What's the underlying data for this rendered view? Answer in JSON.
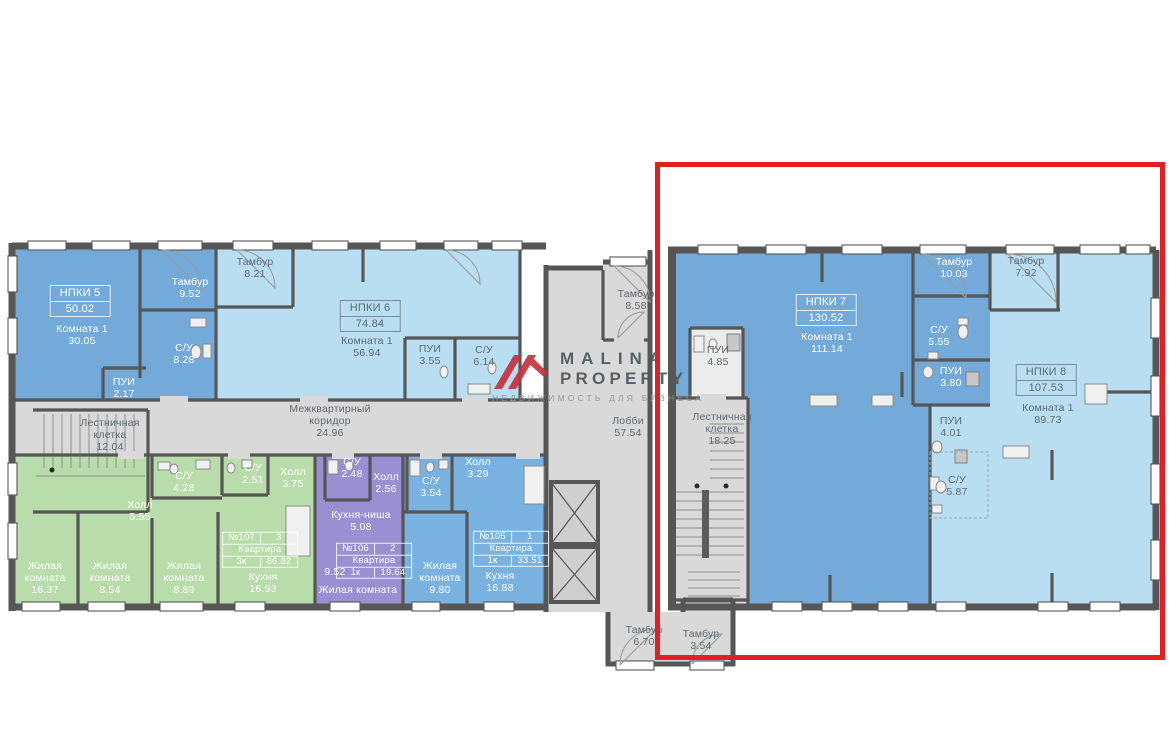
{
  "watermark": {
    "brand_line1": "MALINA",
    "brand_line2": "PROPERTY",
    "tagline": "НЕДВИЖИМОСТЬ ДЛЯ БИЗНЕСА",
    "logo_color": "#c8323c"
  },
  "highlight": {
    "color": "#e31e24"
  },
  "colors": {
    "wall": "#565656",
    "floor_gray": "#d9d9d9",
    "blue_med": "#73aad9",
    "blue_light": "#b9def2",
    "blue_apt": "#79b2e0",
    "green": "#b8dcaa",
    "purple": "#9a8fd2",
    "red": "#e31e24"
  },
  "labels": [
    {
      "id": "npki5-title",
      "type": "titlebox",
      "tone": "light",
      "x": 80,
      "y": 301,
      "lines": [
        "НПКИ 5",
        "50.02"
      ]
    },
    {
      "id": "npki5-room",
      "type": "stack",
      "tone": "light",
      "x": 82,
      "y": 336,
      "lines": [
        "Комната 1",
        "30.05"
      ]
    },
    {
      "id": "npki5-tambur",
      "type": "stack",
      "tone": "light",
      "x": 190,
      "y": 289,
      "lines": [
        "Тамбур",
        "9.52"
      ]
    },
    {
      "id": "npki5-su",
      "type": "stack",
      "tone": "light",
      "x": 184,
      "y": 355,
      "lines": [
        "С/У",
        "8.28"
      ]
    },
    {
      "id": "npki5-pui",
      "type": "stack",
      "tone": "light",
      "x": 124,
      "y": 389,
      "lines": [
        "ПУИ",
        "2.17"
      ]
    },
    {
      "id": "stairwell-12",
      "type": "stack",
      "tone": "dark",
      "x": 110,
      "y": 436,
      "lines": [
        "Лестничная",
        "клетка",
        "12.04"
      ]
    },
    {
      "id": "tambur-821",
      "type": "stack",
      "tone": "dark",
      "x": 255,
      "y": 269,
      "lines": [
        "Тамбур",
        "8.21"
      ]
    },
    {
      "id": "npki6-title",
      "type": "titlebox",
      "tone": "dark",
      "x": 370,
      "y": 316,
      "lines": [
        "НПКИ 6",
        "74.84"
      ]
    },
    {
      "id": "npki6-room",
      "type": "stack",
      "tone": "dark",
      "x": 367,
      "y": 348,
      "lines": [
        "Комната 1",
        "56.94"
      ]
    },
    {
      "id": "npki6-pui",
      "type": "stack",
      "tone": "dark",
      "x": 430,
      "y": 356,
      "lines": [
        "ПУИ",
        "3.55"
      ]
    },
    {
      "id": "npki6-su",
      "type": "stack",
      "tone": "dark",
      "x": 484,
      "y": 357,
      "lines": [
        "С/У",
        "6.14"
      ]
    },
    {
      "id": "corridor",
      "type": "stack",
      "tone": "dark",
      "x": 330,
      "y": 422,
      "lines": [
        "Межквартирный",
        "коридор",
        "24.96"
      ]
    },
    {
      "id": "a107-hall1",
      "type": "stack",
      "tone": "light",
      "x": 140,
      "y": 512,
      "lines": [
        "Холл",
        "5.55"
      ]
    },
    {
      "id": "a107-su1",
      "type": "stack",
      "tone": "light",
      "x": 184,
      "y": 483,
      "lines": [
        "С/У",
        "4.28"
      ]
    },
    {
      "id": "a107-su2",
      "type": "stack",
      "tone": "light",
      "x": 253,
      "y": 475,
      "lines": [
        "С/У",
        "2.51"
      ]
    },
    {
      "id": "a107-hall2",
      "type": "stack",
      "tone": "light",
      "x": 293,
      "y": 479,
      "lines": [
        "Холл",
        "3.75"
      ]
    },
    {
      "id": "a107-room1",
      "type": "stack",
      "tone": "light",
      "x": 45,
      "y": 579,
      "lines": [
        "Жилая",
        "комната",
        "16.37"
      ]
    },
    {
      "id": "a107-room2",
      "type": "stack",
      "tone": "light",
      "x": 110,
      "y": 579,
      "lines": [
        "Жилая",
        "комната",
        "8.54"
      ]
    },
    {
      "id": "a107-room3",
      "type": "stack",
      "tone": "light",
      "x": 184,
      "y": 579,
      "lines": [
        "Жилая",
        "комната",
        "8.89"
      ]
    },
    {
      "id": "a107-kitchen",
      "type": "stack",
      "tone": "light",
      "x": 263,
      "y": 584,
      "lines": [
        "Кухня",
        "16.93"
      ]
    },
    {
      "id": "a107-box",
      "type": "aptbox",
      "tone": "light",
      "x": 260,
      "y": 550,
      "rows": [
        [
          "№107",
          "3"
        ],
        [
          "Квартира"
        ],
        [
          "3к",
          "66.82"
        ]
      ]
    },
    {
      "id": "a106-su",
      "type": "stack",
      "tone": "light",
      "x": 352,
      "y": 469,
      "lines": [
        "С/У",
        "2.48"
      ]
    },
    {
      "id": "a106-hall",
      "type": "stack",
      "tone": "light",
      "x": 386,
      "y": 484,
      "lines": [
        "Холл",
        "2.56"
      ]
    },
    {
      "id": "a106-niche",
      "type": "stack",
      "tone": "light",
      "x": 361,
      "y": 522,
      "lines": [
        "Кухня-ниша",
        "5.08"
      ]
    },
    {
      "id": "a106-box",
      "type": "aptbox",
      "tone": "light",
      "x": 374,
      "y": 561,
      "rows": [
        [
          "№106",
          "2"
        ],
        [
          "Квартира"
        ],
        [
          "1к",
          "19.64"
        ]
      ]
    },
    {
      "id": "a106-area",
      "type": "stack",
      "tone": "light",
      "x": 335,
      "y": 573,
      "lines": [
        "9.52"
      ]
    },
    {
      "id": "a106-room",
      "type": "stack",
      "tone": "light",
      "x": 358,
      "y": 591,
      "lines": [
        "Жилая комната"
      ]
    },
    {
      "id": "a105-su",
      "type": "stack",
      "tone": "light",
      "x": 431,
      "y": 488,
      "lines": [
        "С/У",
        "3.54"
      ]
    },
    {
      "id": "a105-hall",
      "type": "stack",
      "tone": "light",
      "x": 478,
      "y": 469,
      "lines": [
        "Холл",
        "3.29"
      ]
    },
    {
      "id": "a105-room",
      "type": "stack",
      "tone": "light",
      "x": 440,
      "y": 579,
      "lines": [
        "Жилая",
        "комната",
        "9.80"
      ]
    },
    {
      "id": "a105-box",
      "type": "aptbox",
      "tone": "light",
      "x": 511,
      "y": 549,
      "rows": [
        [
          "№105",
          "1"
        ],
        [
          "Квартира"
        ],
        [
          "1к",
          "33.51"
        ]
      ]
    },
    {
      "id": "a105-kitchen",
      "type": "stack",
      "tone": "light",
      "x": 500,
      "y": 583,
      "lines": [
        "Кухня",
        "16.88"
      ]
    },
    {
      "id": "tambur-858",
      "type": "stack",
      "tone": "dark",
      "x": 636,
      "y": 301,
      "lines": [
        "Тамбур",
        "8.58"
      ]
    },
    {
      "id": "lobby",
      "type": "stack",
      "tone": "dark",
      "x": 628,
      "y": 428,
      "lines": [
        "Лобби",
        "57.54"
      ]
    },
    {
      "id": "tambur-670",
      "type": "stack",
      "tone": "dark",
      "x": 644,
      "y": 637,
      "lines": [
        "Тамбур",
        "6.70"
      ]
    },
    {
      "id": "tambur-354",
      "type": "stack",
      "tone": "dark",
      "x": 701,
      "y": 641,
      "lines": [
        "Тамбур",
        "3.54"
      ]
    },
    {
      "id": "pui-485",
      "type": "stack",
      "tone": "dark",
      "x": 718,
      "y": 357,
      "lines": [
        "ПУИ",
        "4.85"
      ]
    },
    {
      "id": "stairwell-18",
      "type": "stack",
      "tone": "dark",
      "x": 722,
      "y": 430,
      "lines": [
        "Лестничная",
        "клетка",
        "18.25"
      ]
    },
    {
      "id": "npki7-title",
      "type": "titlebox",
      "tone": "light",
      "x": 826,
      "y": 310,
      "lines": [
        "НПКИ 7",
        "130.52"
      ]
    },
    {
      "id": "npki7-room",
      "type": "stack",
      "tone": "light",
      "x": 827,
      "y": 344,
      "lines": [
        "Комната 1",
        "111.14"
      ]
    },
    {
      "id": "npki7-tambur",
      "type": "stack",
      "tone": "light",
      "x": 954,
      "y": 269,
      "lines": [
        "Тамбур",
        "10.03"
      ]
    },
    {
      "id": "npki7-su",
      "type": "stack",
      "tone": "light",
      "x": 939,
      "y": 337,
      "lines": [
        "С/У",
        "5.55"
      ]
    },
    {
      "id": "npki7-pui",
      "type": "stack",
      "tone": "light",
      "x": 951,
      "y": 378,
      "lines": [
        "ПУИ",
        "3.80"
      ]
    },
    {
      "id": "tambur-792",
      "type": "stack",
      "tone": "dark",
      "x": 1026,
      "y": 268,
      "lines": [
        "Тамбур",
        "7.92"
      ]
    },
    {
      "id": "npki8-title",
      "type": "titlebox",
      "tone": "dark",
      "x": 1046,
      "y": 380,
      "lines": [
        "НПКИ 8",
        "107.53"
      ]
    },
    {
      "id": "npki8-room",
      "type": "stack",
      "tone": "dark",
      "x": 1048,
      "y": 415,
      "lines": [
        "Комната 1",
        "89.73"
      ]
    },
    {
      "id": "npki8-pui",
      "type": "stack",
      "tone": "dark",
      "x": 951,
      "y": 428,
      "lines": [
        "ПУИ",
        "4.01"
      ]
    },
    {
      "id": "npki8-su",
      "type": "stack",
      "tone": "dark",
      "x": 957,
      "y": 487,
      "lines": [
        "С/У",
        "5.87"
      ]
    }
  ]
}
